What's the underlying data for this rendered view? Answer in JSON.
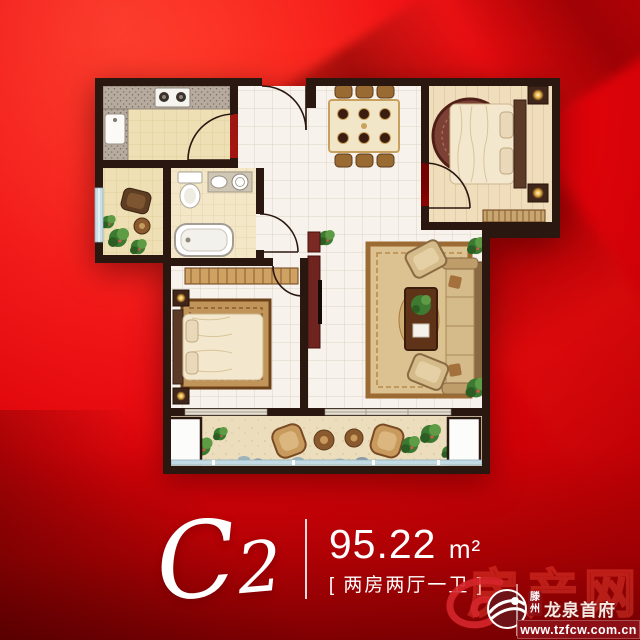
{
  "caption": {
    "unit": "C2",
    "area": "95.22",
    "area_unit": "m²",
    "layout": "[ 两房两厅一卫 ]"
  },
  "watermark": {
    "big": "房产网",
    "city_top": "滕",
    "city_bottom": "州",
    "project": "龙泉首府",
    "url": "www.tzfcw.com.cn"
  },
  "colors": {
    "background_red": "#e10409",
    "deep_red": "#8c1016",
    "wall": "#2a1710",
    "tile_white": "#f7f3ec",
    "floor_beige": "#eedfb4",
    "wood": "#efddbb",
    "rug_gold": "#d5b989",
    "window_blue": "#c2dbe4",
    "plant_green": "#3c7a31"
  }
}
